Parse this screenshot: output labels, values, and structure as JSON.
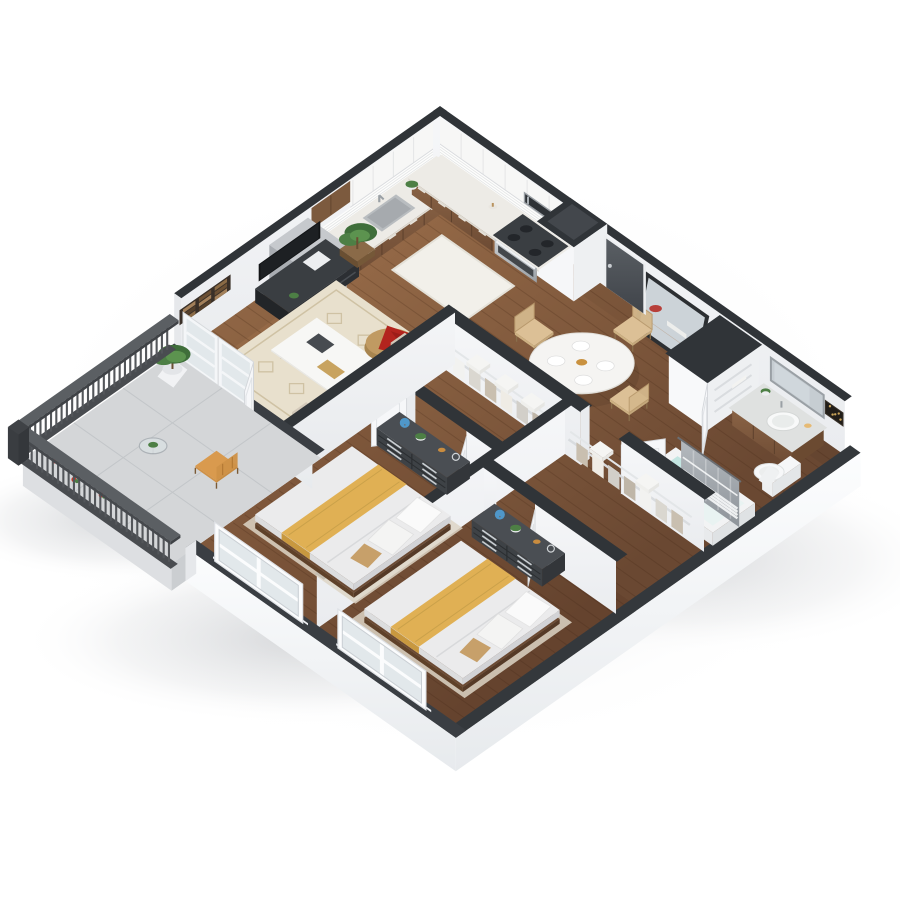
{
  "scene": {
    "description": "3D isometric dollhouse rendering of a two-bedroom, one-bathroom apartment floor plan with open kitchen-living-dining area, two walk-in closets and a private balcony",
    "style": "cutaway isometric architectural render",
    "background": "#ffffff"
  },
  "palette": {
    "wallFaceLight": "#fbfcfd",
    "wallFaceDim": "#e9ebee",
    "wallInterior": "#f3f4f6",
    "wallCap": "#303438",
    "lowWallCap": "#3a3e43",
    "floorWoodLight": "#a5764f",
    "floorWoodDark": "#6a4832",
    "balconyFloor": "#d4d6d8",
    "railing": "#53565a",
    "cabinetWood": "#81593a",
    "cabinetWhite": "#f7f7f6",
    "counter": "#edebe6",
    "backsplash": "#fdfdfc",
    "steel": "#b7bbc0",
    "entryDoor": "#4b5055",
    "doorWhite": "#f6f7f9",
    "blanketYellow": "#e0b054",
    "blanketYellowShade": "#c8983f",
    "mattress": "#ebebec",
    "dresserDark": "#3e4246",
    "sofaBeige": "#d9cfc1",
    "throwRed": "#b3241e",
    "poufTan": "#c09a62",
    "plantGreen": "#4d7f45",
    "plantGreenDark": "#3f6e3a",
    "plantGreenLight": "#5c934f",
    "mirrorGlass": "#ccd3d8",
    "mirrorFrame": "#2c2f32",
    "curtainGray": "#a0a6ac",
    "tubWater": "#bfe3df",
    "rugLiving": "#e8e0cd",
    "rugPattern": "#cfc2a4",
    "rugShag": "#f2f0ea",
    "rugBedroom": "#ddd5c6",
    "chairWood": "#d9bd92",
    "balconyChair": "#d99a4e",
    "artWoodTones": [
      "#8a6a45",
      "#6b4f33",
      "#a3805a",
      "#55402b"
    ],
    "artBathBase": "#221e19",
    "artBathGold": "#caa45a",
    "windowGlass": "#e0e7ea"
  },
  "rooms": [
    {
      "id": "kitchen",
      "label": "Kitchen"
    },
    {
      "id": "living-room",
      "label": "Living Room"
    },
    {
      "id": "dining-area",
      "label": "Dining Area"
    },
    {
      "id": "entry",
      "label": "Entry"
    },
    {
      "id": "bathroom",
      "label": "Bathroom"
    },
    {
      "id": "linen-closet",
      "label": "Linen Closet"
    },
    {
      "id": "walk-in-closet-1",
      "label": "Walk-in Closet 1"
    },
    {
      "id": "walk-in-closet-2",
      "label": "Walk-in Closet 2"
    },
    {
      "id": "bedroom-1",
      "label": "Bedroom 1"
    },
    {
      "id": "bedroom-2",
      "label": "Bedroom 2"
    },
    {
      "id": "balcony",
      "label": "Balcony"
    }
  ],
  "furniture": {
    "kitchen": [
      "refrigerator",
      "base-cabinets",
      "upper-cabinets",
      "sink",
      "range-oven",
      "microwave",
      "tile-backsplash",
      "shag-rug",
      "counter-plant"
    ],
    "living_room": [
      "tv-stand",
      "tv",
      "sofa",
      "coffee-table",
      "pouf-with-red-throw",
      "patterned-rug",
      "wood-wall-art",
      "tall-potted-plant"
    ],
    "dining_area": [
      "round-dining-table",
      "four-woven-chairs",
      "leaning-floor-mirror"
    ],
    "entry": [
      "charcoal-entry-door",
      "column-chase"
    ],
    "bathroom": [
      "wood-vanity",
      "oval-sink",
      "vanity-mirror",
      "toilet",
      "bathtub",
      "striped-shower-curtain",
      "speckled-wall-art"
    ],
    "linen_closet": [
      "shelves",
      "open-door"
    ],
    "walk_in_closets": [
      "wire-shelving",
      "hanging-clothes",
      "folded-linens",
      "open-doors"
    ],
    "bedroom_1": [
      "bed-with-yellow-runner",
      "pillows",
      "six-drawer-dresser",
      "decor-globe-plant",
      "rug",
      "window"
    ],
    "bedroom_2": [
      "bed-with-yellow-runner",
      "pillows",
      "six-drawer-dresser",
      "decor-globe-plant",
      "rug",
      "window"
    ],
    "balcony": [
      "slat-railing",
      "tall-potted-plant",
      "bistro-table",
      "wood-slat-chair",
      "red-flowers"
    ]
  }
}
